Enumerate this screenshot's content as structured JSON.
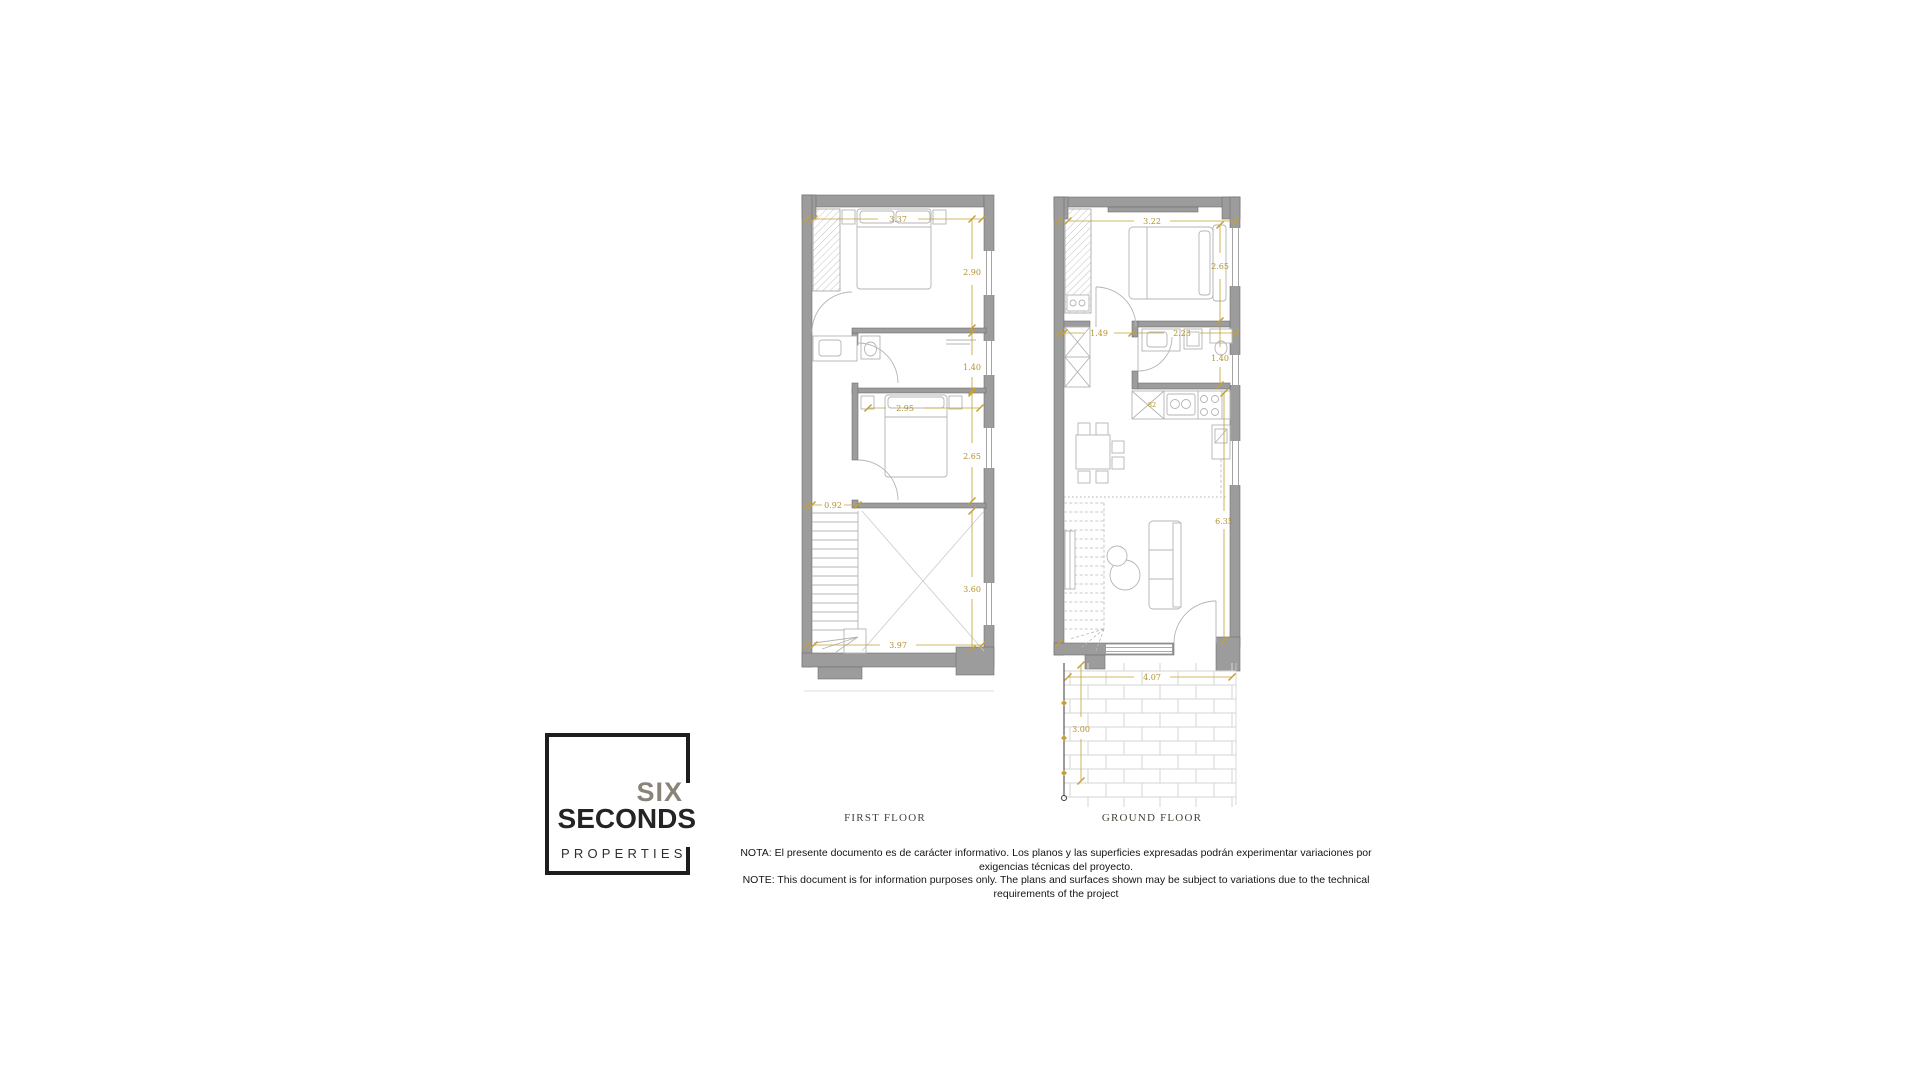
{
  "document": {
    "background": "#ffffff"
  },
  "plans": {
    "first": {
      "label": "FIRST FLOOR",
      "dims": {
        "bedroom1_width": "3.37",
        "bedroom1_depth": "2.90",
        "bathroom_depth": "1.40",
        "bedroom2_width": "2.95",
        "bedroom2_depth": "2.65",
        "stair_width": "0.92",
        "void_depth": "3.60",
        "total_width": "3.97"
      }
    },
    "ground": {
      "label": "GROUND FLOOR",
      "dims": {
        "bedroom_width": "3.22",
        "bedroom_depth": "2.65",
        "hall_width": "1.49",
        "bathroom_width": "2.23",
        "bathroom_depth": "1.40",
        "kitchen_detail": "82",
        "living_depth": "6.35",
        "terrace_width": "4.07",
        "terrace_depth": "3.00"
      }
    }
  },
  "logo": {
    "top": "SIX",
    "middle": "SECONDS",
    "bottom": "PROPERTIES"
  },
  "note": {
    "line1": "NOTA: El presente documento es de carácter informativo. Los planos y las superficies expresadas podrán experimentar variaciones por exigencias técnicas del proyecto.",
    "line2": "NOTE: This document is for information purposes only. The plans and surfaces shown may be subject to variations due to the technical requirements of the project"
  },
  "colors": {
    "dimension": "#c3a136",
    "wall_fill": "#9c9c9c",
    "wall_stroke": "#717171",
    "furniture": "#b4b4b4",
    "label_text": "#45433a"
  }
}
